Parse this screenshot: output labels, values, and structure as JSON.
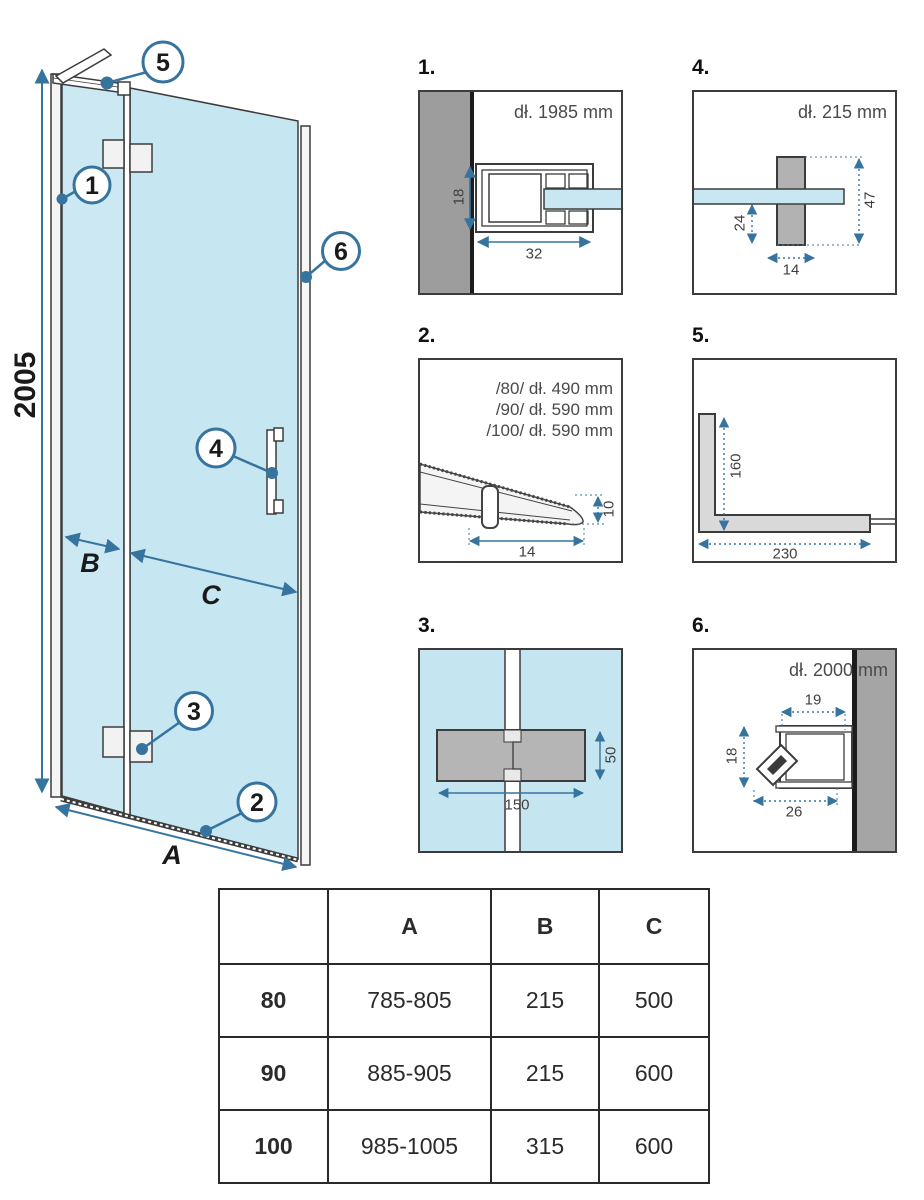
{
  "colors": {
    "accent": "#36749f",
    "glass": "#c9e7f3",
    "wall_gray": "#9d9d9d",
    "hinge_gray": "#b5b5b5",
    "outline": "#3c3c3c"
  },
  "main_diagram": {
    "height_dim": "2005",
    "width_dim_label": "A",
    "fixed_panel_dim_label": "B",
    "door_dim_label": "C",
    "callouts": [
      "1",
      "2",
      "3",
      "4",
      "5",
      "6"
    ]
  },
  "panels": {
    "p1": {
      "label": "1.",
      "title": "dł. 1985 mm",
      "dim_w": "32",
      "dim_h": "18"
    },
    "p2": {
      "label": "2.",
      "lines": [
        "/80/ dł. 490 mm",
        "/90/ dł. 590 mm",
        "/100/ dł. 590 mm"
      ],
      "dim_w": "14",
      "dim_h": "10"
    },
    "p3": {
      "label": "3.",
      "dim_w": "150",
      "dim_h": "50"
    },
    "p4": {
      "label": "4.",
      "title": "dł. 215 mm",
      "dim_w": "14",
      "dim_h": "47",
      "dim_h2": "24"
    },
    "p5": {
      "label": "5.",
      "dim_w": "230",
      "dim_h": "160"
    },
    "p6": {
      "label": "6.",
      "title": "dł. 2000 mm",
      "dim_w": "26",
      "dim_h": "18",
      "dim_w2": "19"
    }
  },
  "table": {
    "col_headers": [
      "A",
      "B",
      "C"
    ],
    "rows": [
      {
        "size": "80",
        "a": "785-805",
        "b": "215",
        "c": "500"
      },
      {
        "size": "90",
        "a": "885-905",
        "b": "215",
        "c": "600"
      },
      {
        "size": "100",
        "a": "985-1005",
        "b": "315",
        "c": "600"
      }
    ]
  }
}
